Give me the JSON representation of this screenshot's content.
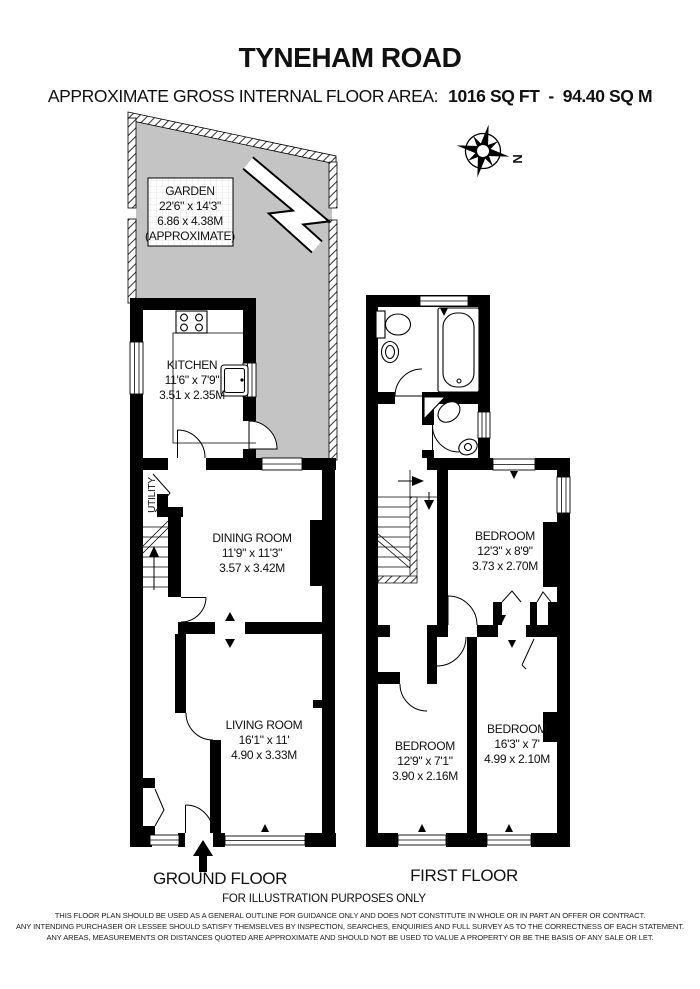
{
  "header": {
    "title": "TYNEHAM ROAD",
    "area_label": "APPROXIMATE GROSS INTERNAL FLOOR AREA:",
    "area_value": "1016 SQ FT  -  94.40 SQ M"
  },
  "compass": {
    "label": "N"
  },
  "garden": {
    "name": "GARDEN",
    "dims_imperial": "22'6\" x 14'3\"",
    "dims_metric": "6.86 x 4.38M",
    "note": "(APPROXIMATE)"
  },
  "ground_floor": {
    "label": "GROUND FLOOR",
    "rooms": {
      "kitchen": {
        "name": "KITCHEN",
        "dims_imperial": "11'6\" x 7'9\"",
        "dims_metric": "3.51 x 2.35M"
      },
      "utility": {
        "name": "UTILITY"
      },
      "dining_room": {
        "name": "DINING ROOM",
        "dims_imperial": "11'9\" x 11'3\"",
        "dims_metric": "3.57 x 3.42M"
      },
      "living_room": {
        "name": "LIVING ROOM",
        "dims_imperial": "16'1\" x 11'",
        "dims_metric": "4.90 x 3.33M"
      }
    }
  },
  "first_floor": {
    "label": "FIRST FLOOR",
    "rooms": {
      "bedroom_1": {
        "name": "BEDROOM",
        "dims_imperial": "12'3\" x 8'9\"",
        "dims_metric": "3.73 x 2.70M"
      },
      "bedroom_2": {
        "name": "BEDROOM",
        "dims_imperial": "12'9\" x 7'1\"",
        "dims_metric": "3.90 x 2.16M"
      },
      "bedroom_3": {
        "name": "BEDROOM",
        "dims_imperial": "16'3\" x 7'",
        "dims_metric": "4.99 x 2.10M"
      }
    }
  },
  "footer": {
    "illustration_note": "FOR ILLUSTRATION PURPOSES ONLY",
    "disclaimer_lines": [
      "THIS FLOOR PLAN SHOULD BE USED AS A GENERAL OUTLINE FOR GUIDANCE ONLY AND DOES NOT CONSTITUTE IN WHOLE OR IN PART AN OFFER OR CONTRACT.",
      "ANY INTENDING PURCHASER OR LESSEE SHOULD SATISFY THEMSELVES BY INSPECTION, SEARCHES, ENQUIRIES AND FULL SURVEY AS TO THE CORRECTNESS OF EACH STATEMENT.",
      "ANY AREAS, MEASUREMENTS OR DISTANCES QUOTED ARE APPROXIMATE AND SHOULD NOT BE USED TO VALUE A PROPERTY OR BE THE BASIS OF ANY SALE OR LET."
    ]
  },
  "colors": {
    "wall": "#000000",
    "garden_fill": "#c4c4c4",
    "background": "#ffffff"
  }
}
